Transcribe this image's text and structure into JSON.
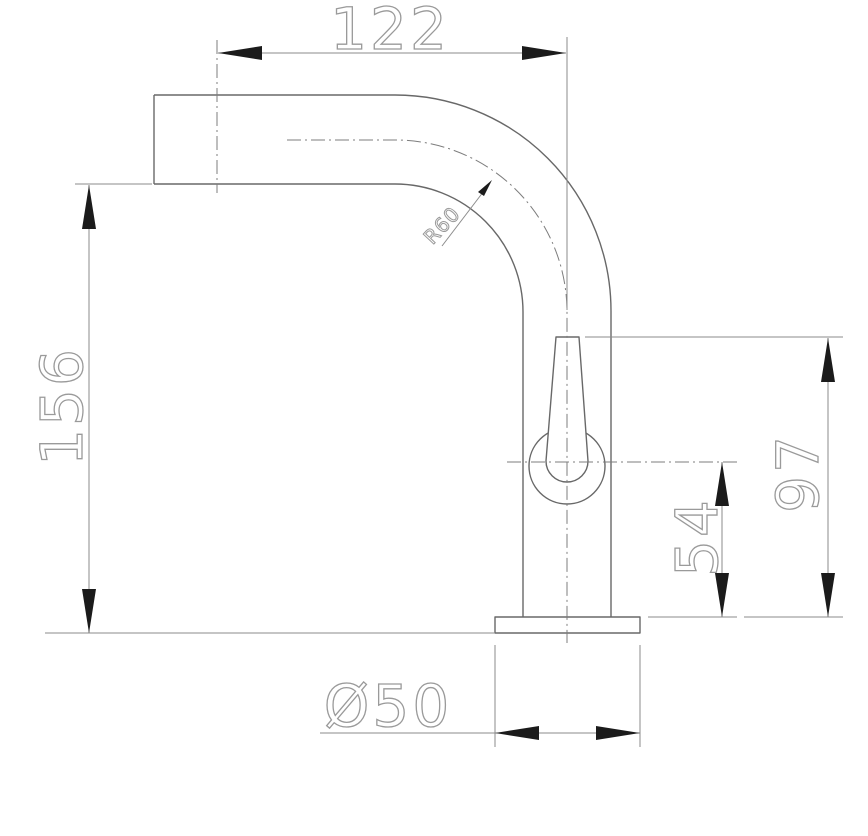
{
  "drawing": {
    "kind": "cad-dimension-drawing",
    "colors": {
      "background": "#ffffff",
      "outline": "#686868",
      "dimension_lines": "#8b8b8b",
      "centerlines": "#7d7d7d",
      "arrowheads": "#1b1b1b",
      "dimension_text": "#9a9a9a"
    },
    "dimensions": {
      "spout_reach": "122",
      "overall_height": "156",
      "handle_top_height": "97",
      "handle_center_height": "54",
      "base_diameter": "Ø50",
      "bend_radius": "R60"
    }
  }
}
